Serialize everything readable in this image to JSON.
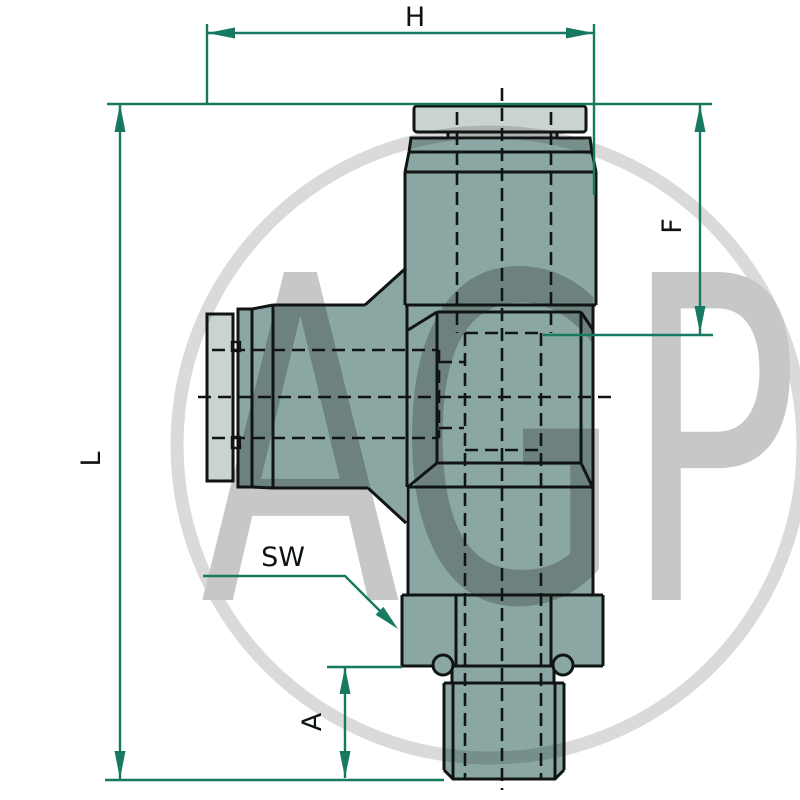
{
  "drawing": {
    "watermark": {
      "text": "AGP"
    },
    "labels": {
      "h": "H",
      "l": "L",
      "f": "F",
      "a": "A",
      "sw": "SW"
    },
    "colors": {
      "dimension": "#17795f",
      "outline": "#101514",
      "body": "#8ba7a3",
      "body_light": "#c9d3d0",
      "watermark_ring": "#dadada",
      "watermark_text": "#c7c7c7",
      "background": "#ffffff"
    }
  }
}
